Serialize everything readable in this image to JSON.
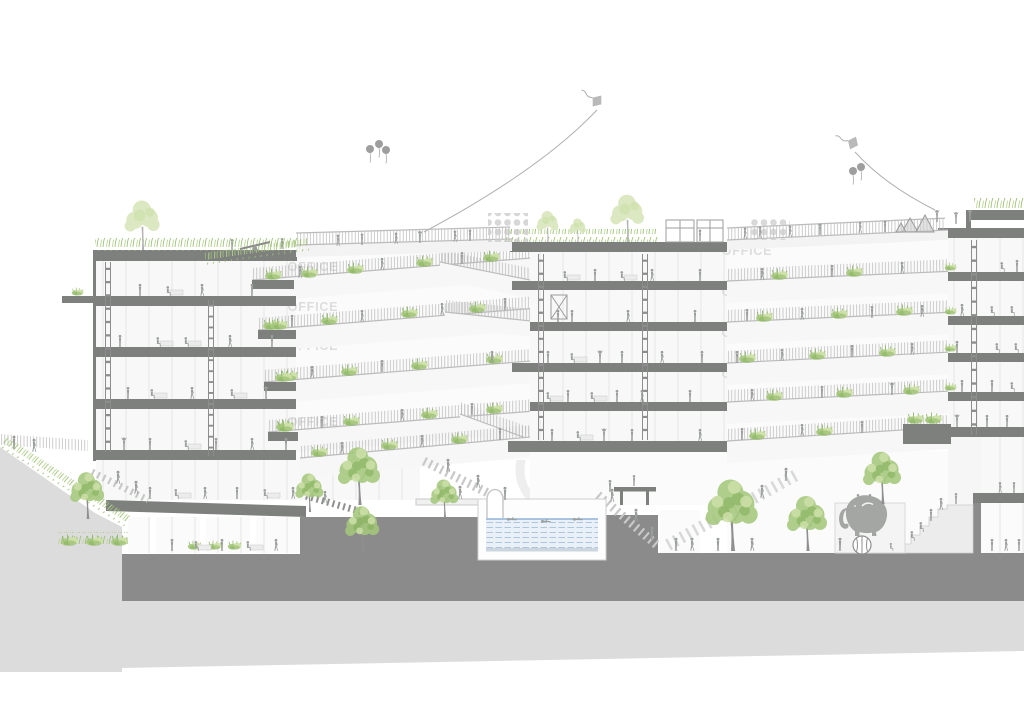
{
  "drawing": {
    "office_label": "OFFICE",
    "scene_elements": [
      "kite",
      "balloons",
      "green-roof",
      "rooftop-trees",
      "pergola",
      "climbing-dots",
      "play-tents",
      "seesaw",
      "office-floors",
      "planted-ramps",
      "ladders",
      "swimming-pool",
      "swimmers",
      "diving-platform",
      "grand-stairs",
      "amphitheater-steps",
      "elephant-on-ball",
      "ground-trees",
      "hillside-lawn",
      "people-silhouettes"
    ]
  },
  "palette": {
    "slab": "#7d807d",
    "poche": "#8b8b8b",
    "ground_light": "#dcdcdc",
    "people": "#9b9f9b",
    "green_light": "#cde0a8",
    "green_mid": "#a5c87c",
    "green_dark": "#7fae55",
    "green_pale": "#d8e6bc",
    "pool_water": "#e9f0f7",
    "pool_stripe": "#a6c1dc",
    "line": "#bcbcbc",
    "label": "#dcdcdc"
  }
}
